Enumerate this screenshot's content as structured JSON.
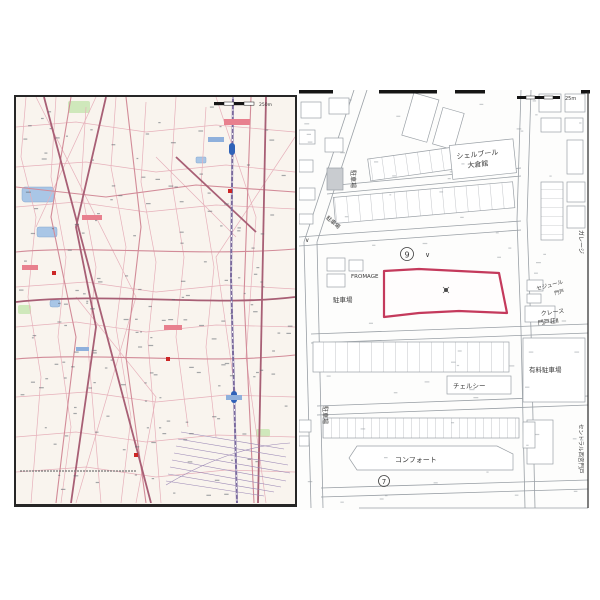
{
  "sheet": {
    "left_map": {
      "name": "wide-area city map",
      "scale_label": "250m"
    },
    "right_map": {
      "name": "detailed residential map",
      "scale_label": "25m",
      "labels": {
        "building_1_line1": "シェルブール",
        "building_1_line2": "大倉館",
        "parking_upper": "駐車場",
        "parking_road": "駐車場",
        "parking_mid": "駐車場",
        "parking_lower": "駐車場",
        "paid_parking": "有料駐車場",
        "fromage": "FROMAGE",
        "garage": "ガレージ",
        "sejour_line1": "セジュール",
        "sejour_line2": "門戸",
        "crece_line1": "クレース",
        "crece_line2": "門戸荘Ⅱ",
        "chelsea": "チェルシー",
        "comfort": "コンフォート",
        "central": "セントラル西宮門戸"
      },
      "markers": {
        "circle_9": "9",
        "circle_7": "7",
        "check": "∨",
        "check2": "∨"
      },
      "parcel": {
        "outline_color": "#c43a5c"
      }
    }
  }
}
